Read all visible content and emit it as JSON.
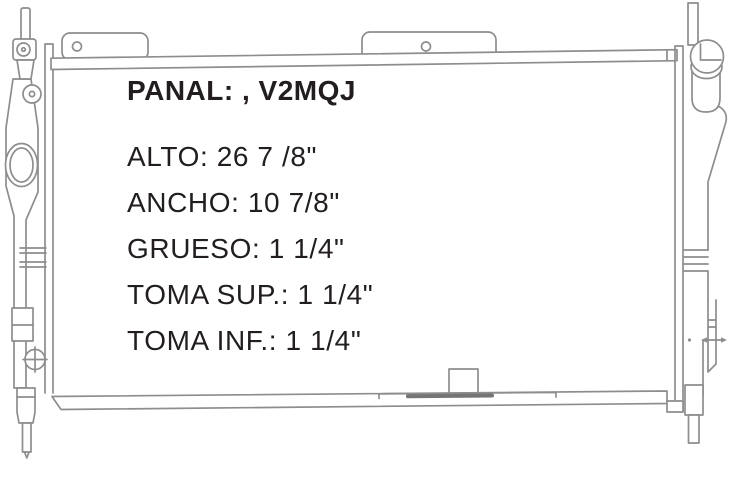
{
  "diagram": {
    "title": {
      "label": "PANAL",
      "value": ", V2MQJ",
      "text": "PANAL: , V2MQJ"
    },
    "specs": [
      {
        "label": "ALTO",
        "value": "26 7 /8\"",
        "text": "ALTO: 26 7 /8\""
      },
      {
        "label": "ANCHO",
        "value": "10 7/8\"",
        "text": "ANCHO: 10 7/8\""
      },
      {
        "label": "GRUESO",
        "value": "1 1/4\"",
        "text": "GRUESO: 1 1/4\""
      },
      {
        "label": "TOMA SUP.",
        "value": "1 1/4\"",
        "text": "TOMA SUP.: 1 1/4\""
      },
      {
        "label": "TOMA INF.",
        "value": "1 1/4\"",
        "text": "TOMA INF.: 1 1/4\""
      }
    ],
    "colors": {
      "line": "#8d8d8d",
      "line_dark": "#757575",
      "text": "#221e1f",
      "background": "#ffffff"
    }
  }
}
